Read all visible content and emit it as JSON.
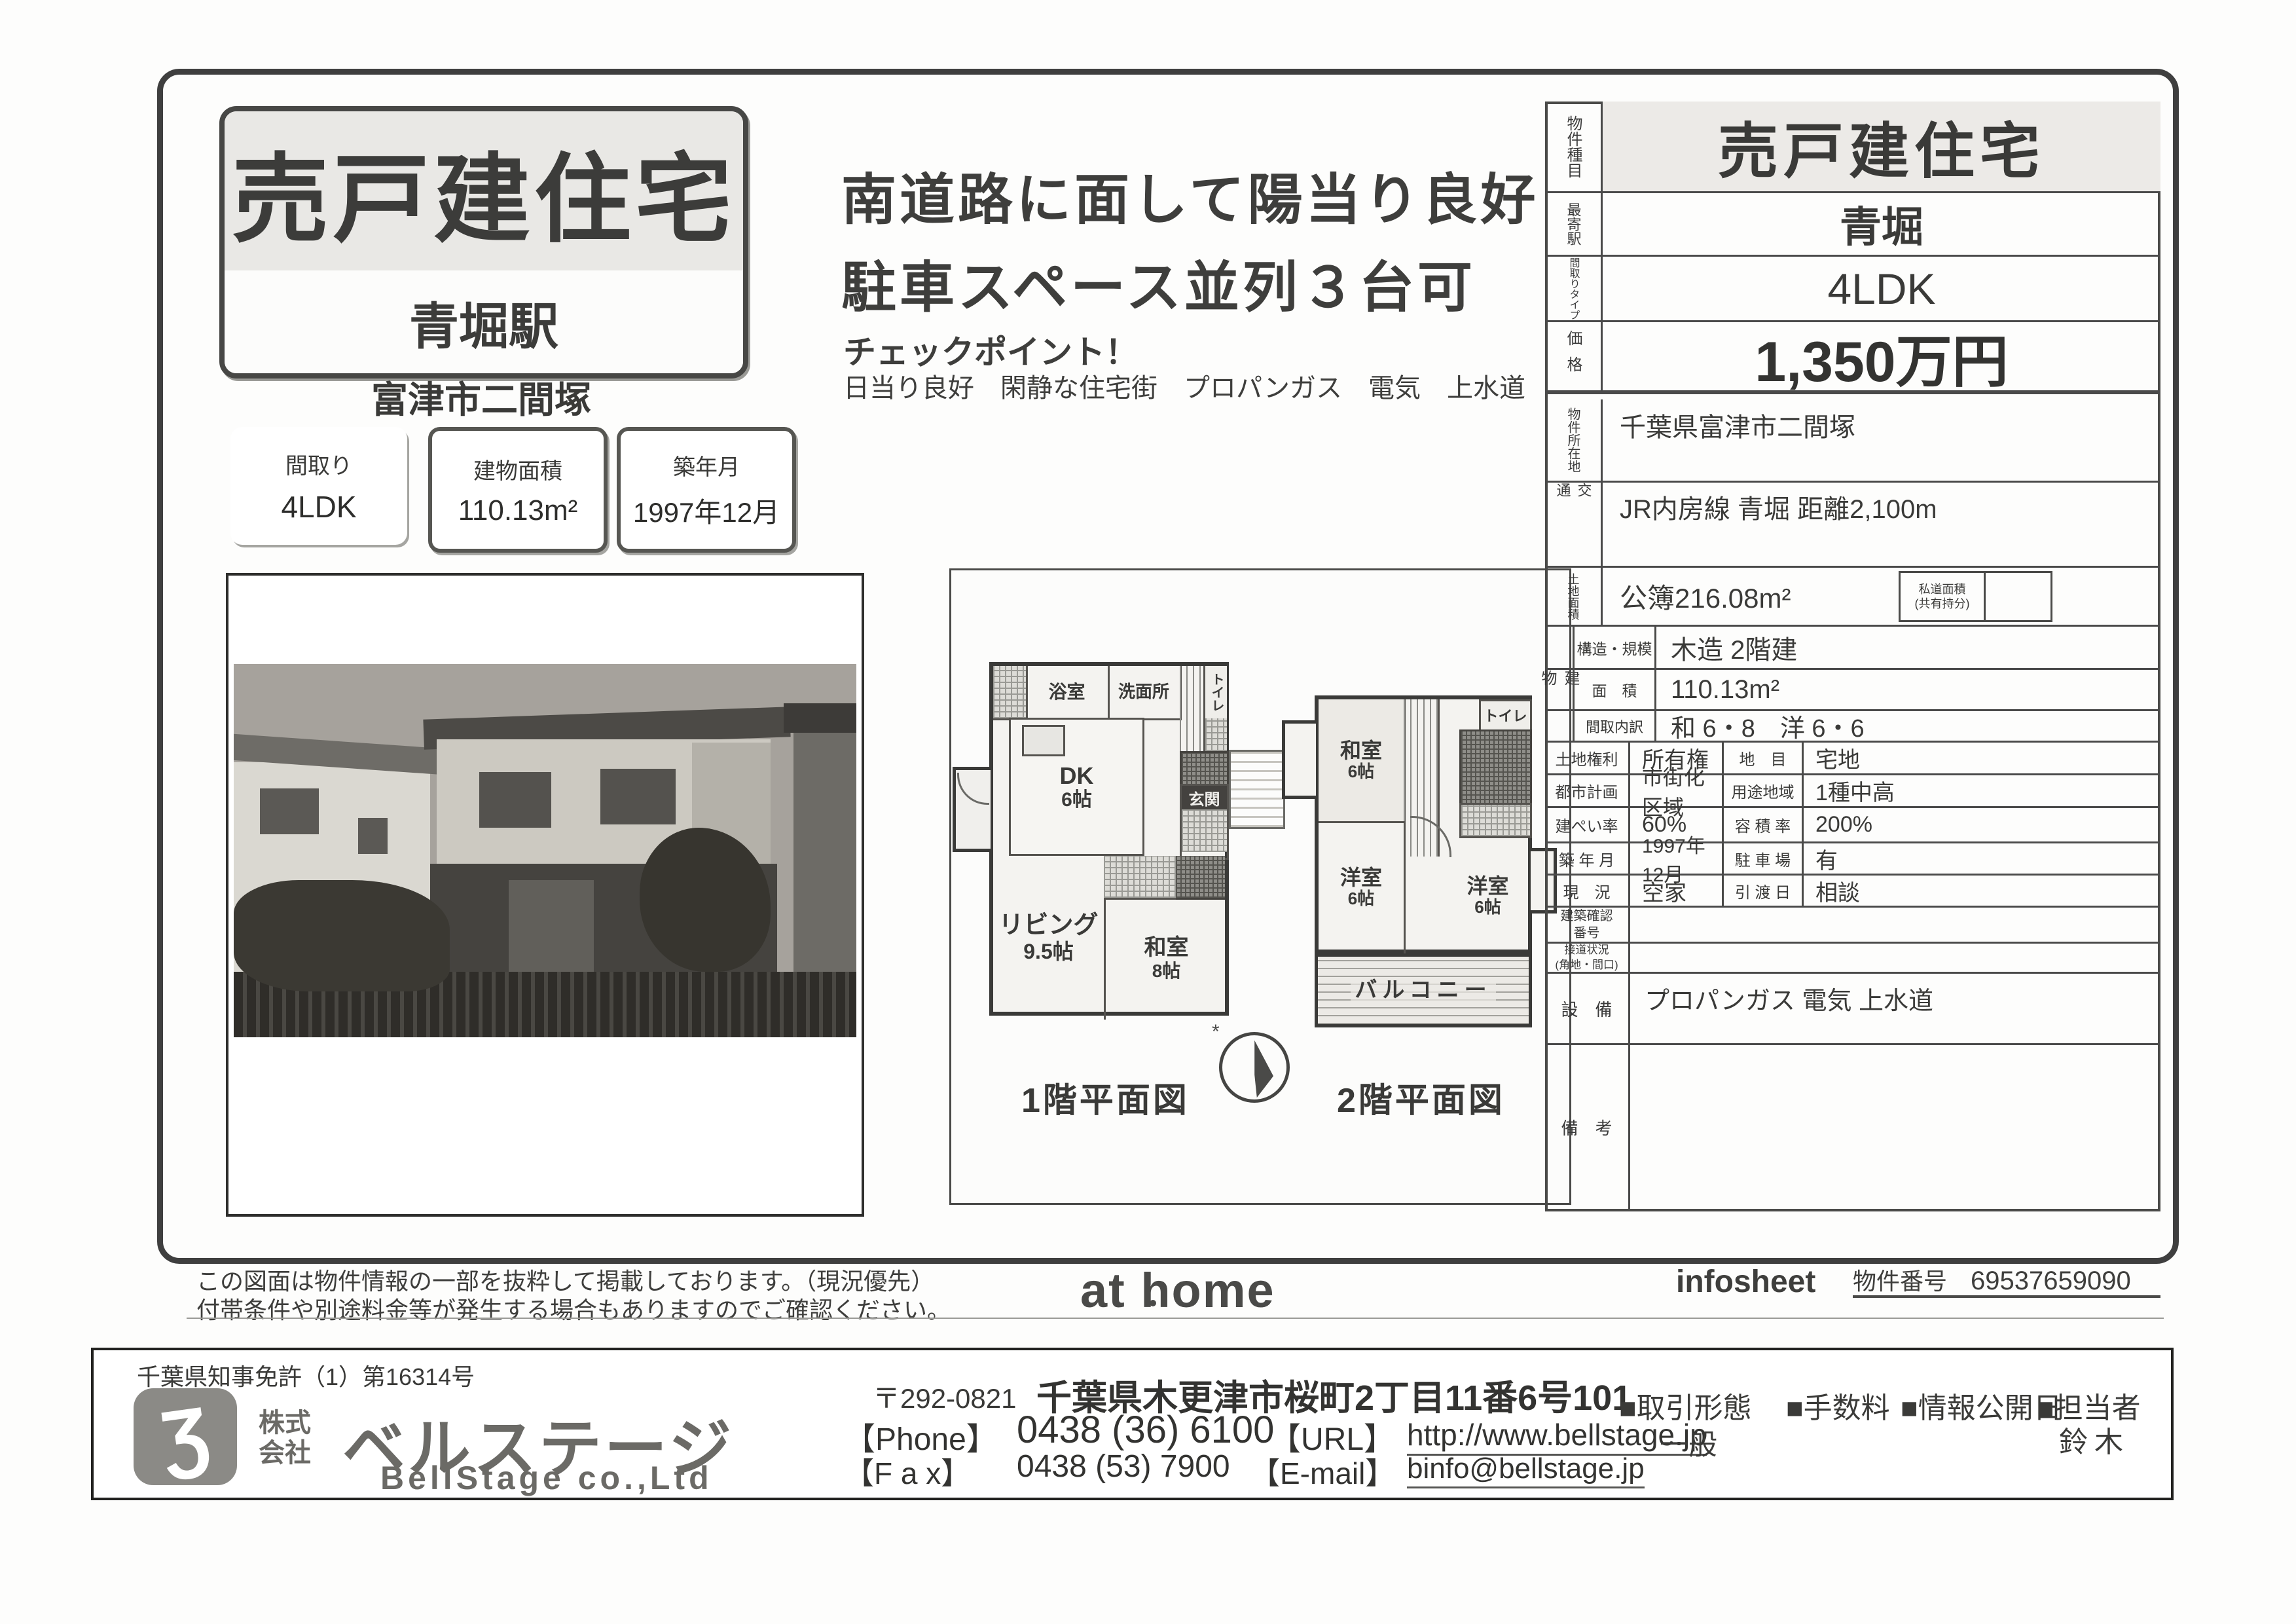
{
  "title_box": {
    "title": "売戸建住宅",
    "station": "青堀駅"
  },
  "location": "富津市二間塚",
  "spec_boxes": [
    {
      "label": "間取り",
      "value": "4LDK"
    },
    {
      "label": "建物面積",
      "value": "110.13m²"
    },
    {
      "label": "築年月",
      "value": "1997年12月"
    }
  ],
  "catch": {
    "line1": "南道路に面して陽当り良好",
    "line2": "駐車スペース並列３台可",
    "checkpoint_title": "チェックポイント！",
    "checkpoint_items": "日当り良好　閑静な住宅街　プロパンガス　電気　上水道"
  },
  "floorplan": {
    "f1": {
      "caption": "1階平面図",
      "bath": "浴室",
      "wash": "洗面所",
      "toilet": "トイレ",
      "dk": "DK",
      "dk_size": "6帖",
      "genkan": "玄関",
      "living": "リビング",
      "living_size": "9.5帖",
      "washitsu": "和室",
      "washitsu_size": "8帖"
    },
    "f2": {
      "caption": "2階平面図",
      "washitsu": "和室",
      "washitsu_size": "6帖",
      "toilet": "トイレ",
      "yoshitsu1": "洋室",
      "yoshitsu1_size": "6帖",
      "yoshitsu2": "洋室",
      "yoshitsu2_size": "6帖",
      "balcony": "バルコニー"
    },
    "north_mark": "*"
  },
  "table": {
    "property_type": {
      "label": "物件種目",
      "value": "売戸建住宅"
    },
    "station": {
      "label": "最寄駅",
      "value": "青堀"
    },
    "layout_type": {
      "label": "間取りタイプ",
      "value": "4LDK"
    },
    "price": {
      "label": "価格",
      "value": "1,350万円"
    },
    "address": {
      "label": "物件所在地",
      "value": "千葉県富津市二間塚"
    },
    "access": {
      "label": "交通",
      "value": "JR内房線 青堀 距離2,100m"
    },
    "land": {
      "label": "土地面積",
      "value": "公簿216.08m²",
      "sub_label": "私道面積\n(共有持分)",
      "sub_value": ""
    },
    "building": {
      "label": "建物",
      "r1_label": "構造・規模",
      "r1_value": "木造 2階建",
      "r2_label": "面　積",
      "r2_value": "110.13m²",
      "r3_label": "間取内訳",
      "r3_value": "和 6・8　洋 6・6"
    },
    "pairs": [
      {
        "l1": "土地権利",
        "v1": "所有権",
        "l2": "地　目",
        "v2": "宅地"
      },
      {
        "l1": "都市計画",
        "v1": "市街化区域",
        "l2": "用途地域",
        "v2": "1種中高"
      },
      {
        "l1": "建ぺい率",
        "v1": "60%",
        "l2": "容 積 率",
        "v2": "200%"
      },
      {
        "l1": "築 年 月",
        "v1": "1997年12月",
        "l2": "駐 車 場",
        "v2": "有"
      },
      {
        "l1": "現　況",
        "v1": "空家",
        "l2": "引 渡 日",
        "v2": "相談"
      }
    ],
    "kakunin": {
      "label": "建築確認\n番号",
      "value": ""
    },
    "setsudo": {
      "label": "接道状況\n(角地・間口)",
      "value": ""
    },
    "facilities": {
      "label": "設　備",
      "value": "プロパンガス 電気 上水道"
    },
    "remarks": {
      "label": "備　考",
      "value": ""
    }
  },
  "footer": {
    "disclaimer1": "この図面は物件情報の一部を抜粋して掲載しております。（現況優先）",
    "disclaimer2": "付帯条件や別途料金等が発生する場合もありますのでご確認ください。",
    "athome_logo": "at home",
    "infosheet": "infosheet",
    "property_no_label": "物件番号",
    "property_no": "69537659090"
  },
  "company": {
    "license": "千葉県知事免許（1）第16314号",
    "logo_mark": "Ʒ",
    "name_prefix": "株式\n会社",
    "name": "ベルステージ",
    "name_en": "BellStage co.,Ltd",
    "postal": "〒292-0821",
    "address": "千葉県木更津市桜町2丁目11番6号101",
    "phone_label": "【Phone】",
    "phone": "0438 (36) 6100",
    "fax_label": "【F a x】",
    "fax": "0438 (53) 7900",
    "url_label": "【URL】",
    "url": "http://www.bellstage.jp",
    "email_label": "【E-mail】",
    "email": "binfo@bellstage.jp",
    "deal_type_label": "■取引形態",
    "deal_type": "一般",
    "fee_label": "■手数料",
    "disclosure_label": "■情報公開日",
    "agent_label": "■担当者",
    "agent": "鈴木"
  },
  "colors": {
    "ink": "#3a3a38",
    "paper": "#fdfdfc",
    "gray_fill": "#e9e8e5"
  }
}
